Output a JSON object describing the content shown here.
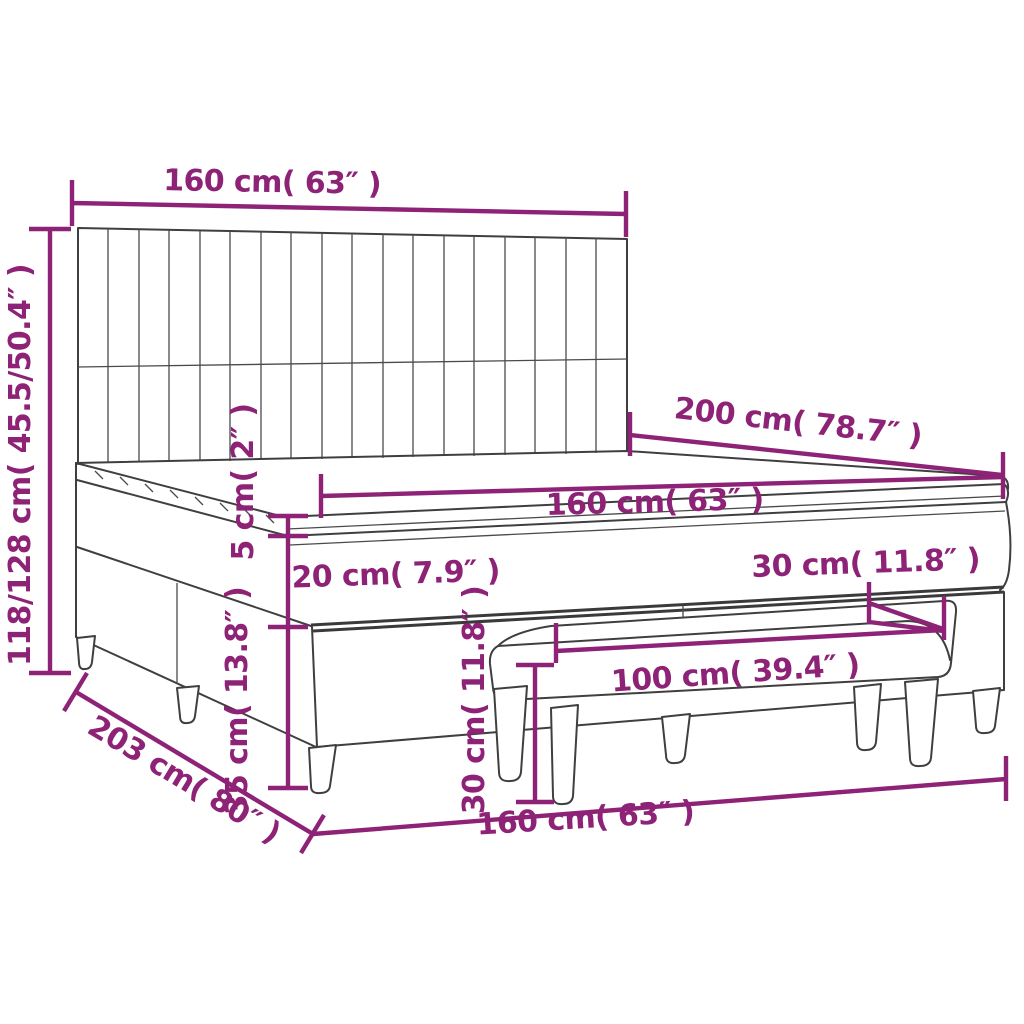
{
  "diagram": {
    "type": "product-dimension-diagram",
    "subject": "box spring bed with headboard, mattress topper and bench",
    "colors": {
      "dimension_accent": "#8d2276",
      "line_art": "#3f3f3f",
      "background": "#ffffff"
    },
    "labels": {
      "headboard_width": "160 cm( 63″ )",
      "total_height": "118/128 cm( 45.5/50.4″ )",
      "bed_length": "200 cm( 78.7″ )",
      "mattress_width": "160 cm( 63″ )",
      "topper_thickness": "5 cm( 2″ )",
      "mattress_thickness": "20 cm( 7.9″ )",
      "bench_depth": "30 cm( 11.8″ )",
      "bench_length": "100 cm( 39.4″ )",
      "bench_height": "30 cm( 11.8″ )",
      "base_height": "35 cm( 13.8″ )",
      "frame_length": "203 cm( 80″ )",
      "frame_width": "160 cm( 63″ )"
    }
  }
}
